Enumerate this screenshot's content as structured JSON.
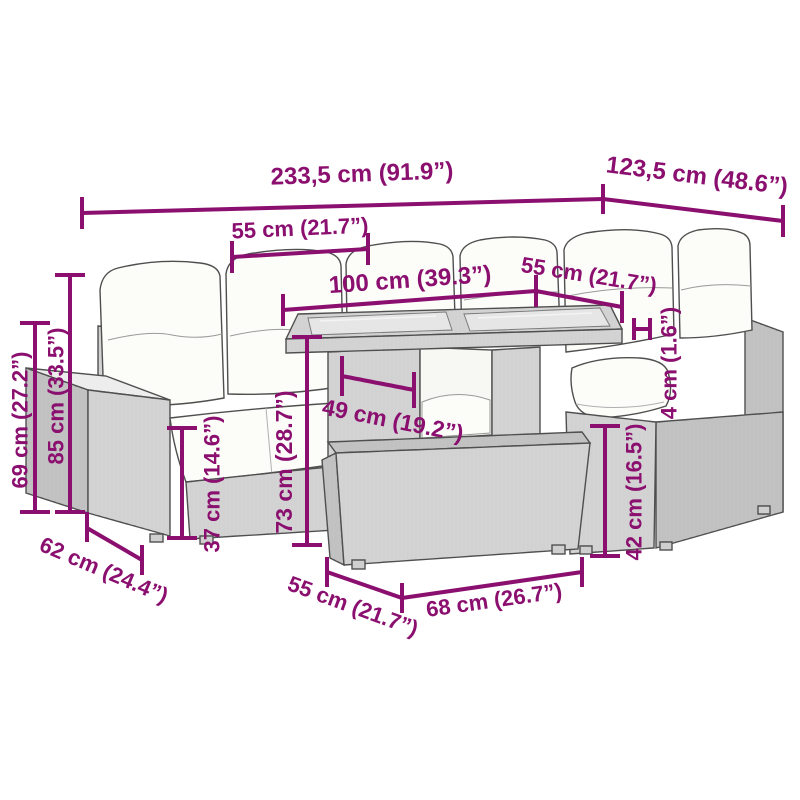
{
  "diagram": {
    "type": "furniture-dimension-diagram",
    "accent_color": "#8b0f6f",
    "dims": {
      "total_width": "233,5 cm (91.9”)",
      "total_depth": "123,5 cm (48.6”)",
      "seat_width_left": "55 cm (21.7”)",
      "table_width": "100 cm (39.3”)",
      "seat_width_right": "55 cm (21.7”)",
      "arm_height": "69 cm (27.2”)",
      "back_height": "85 cm (33.5”)",
      "seat_height": "37 cm (14.6”)",
      "table_height": "73 cm (28.7”)",
      "table_depth": "49 cm (19.2”)",
      "cushion_thickness": "4 cm (1.6”)",
      "ottoman_height": "42 cm (16.5”)",
      "seat_depth": "62 cm (24.4”)",
      "ottoman_depth": "55 cm (21.7”)",
      "ottoman_width": "68 cm (26.7”)"
    }
  }
}
